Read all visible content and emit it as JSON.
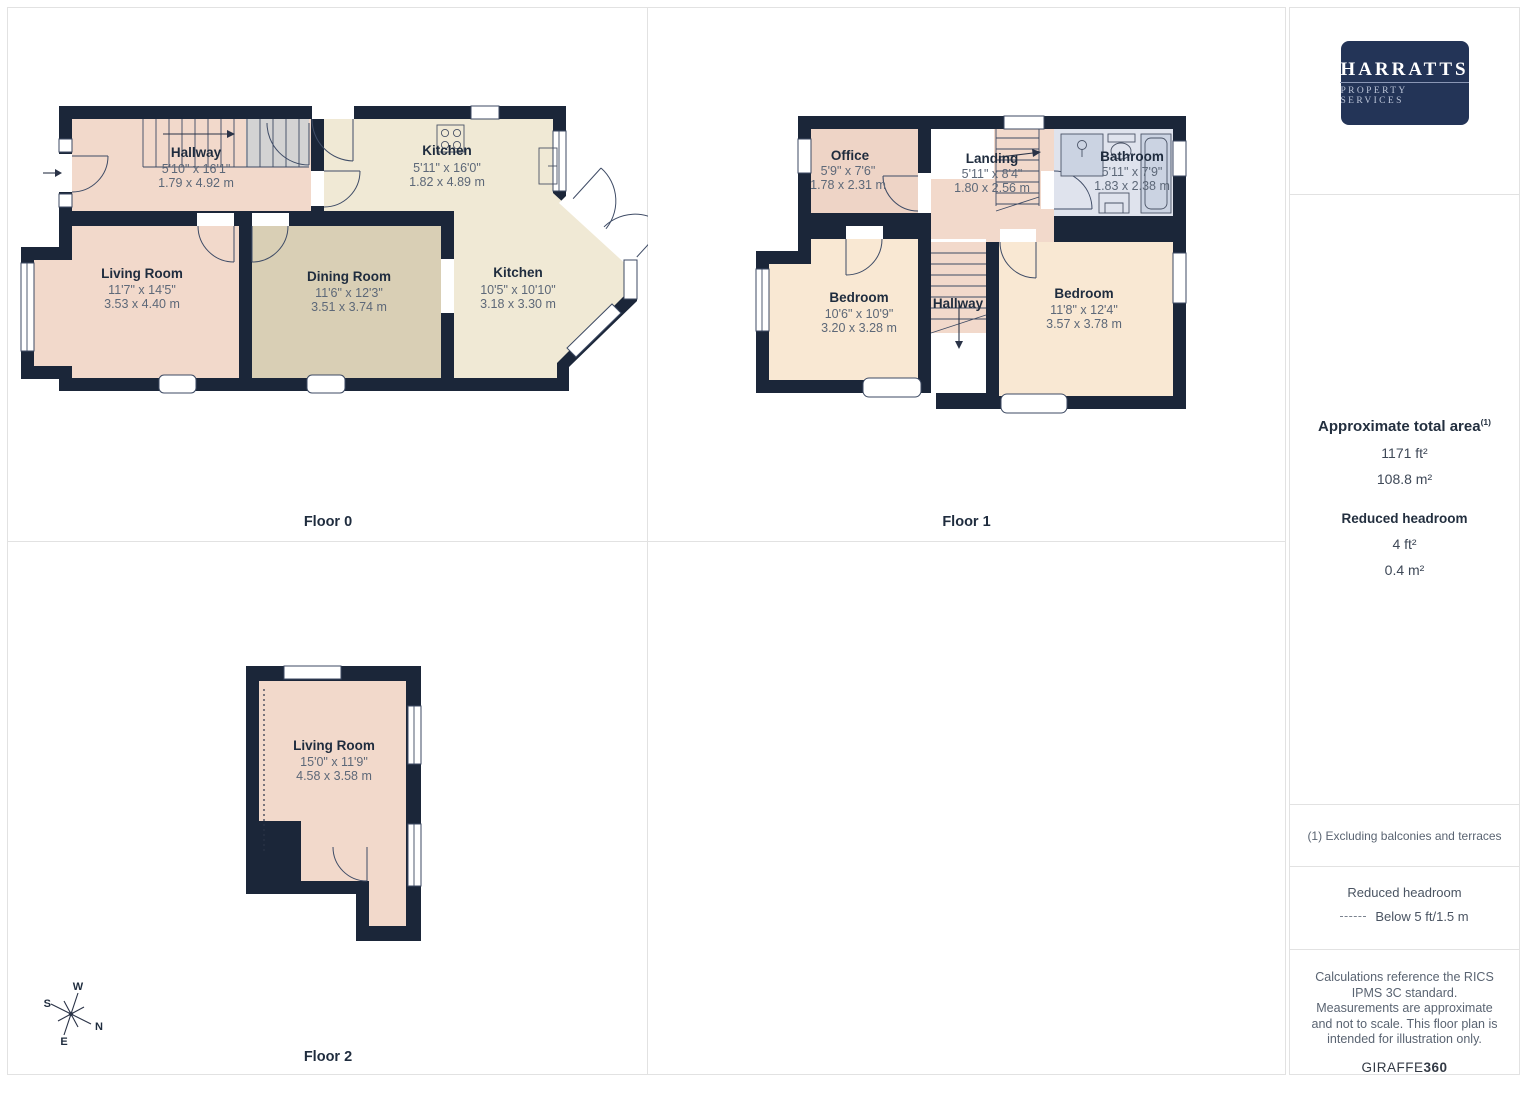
{
  "brand": {
    "logo_line1": "HARRATTS",
    "logo_line2": "PROPERTY SERVICES"
  },
  "sidebar": {
    "total_area": {
      "title": "Approximate total area",
      "superscript": "(1)",
      "value_ft": "1171 ft²",
      "value_m": "108.8 m²"
    },
    "reduced_headroom": {
      "title": "Reduced headroom",
      "value_ft": "4 ft²",
      "value_m": "0.4 m²"
    },
    "footnote": "(1) Excluding balconies and terraces",
    "legend": {
      "title": "Reduced headroom",
      "dash_label": "Below 5 ft/1.5 m"
    },
    "disclaimer": "Calculations reference the RICS IPMS 3C standard. Measurements are approximate and not to scale. This floor plan is intended for illustration only.",
    "watermark_regular": "GIRAFFE",
    "watermark_bold": "360"
  },
  "floors": [
    {
      "label": "Floor 0",
      "rooms": [
        {
          "name": "Hallway",
          "ft": "5'10\" x 16'1\"",
          "m": "1.79 x 4.92 m"
        },
        {
          "name": "Kitchen",
          "ft": "5'11\" x 16'0\"",
          "m": "1.82 x 4.89 m"
        },
        {
          "name": "Living Room",
          "ft": "11'7\" x 14'5\"",
          "m": "3.53 x 4.40 m"
        },
        {
          "name": "Dining Room",
          "ft": "11'6\" x 12'3\"",
          "m": "3.51 x 3.74 m"
        },
        {
          "name": "Kitchen",
          "ft": "10'5\" x 10'10\"",
          "m": "3.18 x 3.30 m"
        }
      ]
    },
    {
      "label": "Floor 1",
      "rooms": [
        {
          "name": "Office",
          "ft": "5'9\" x 7'6\"",
          "m": "1.78 x 2.31 m"
        },
        {
          "name": "Landing",
          "ft": "5'11\" x 8'4\"",
          "m": "1.80 x 2.56 m"
        },
        {
          "name": "Bathroom",
          "ft": "5'11\" x 7'9\"",
          "m": "1.83 x 2.38 m"
        },
        {
          "name": "Bedroom",
          "ft": "10'6\" x 10'9\"",
          "m": "3.20 x 3.28 m"
        },
        {
          "name": "Hallway",
          "ft": "",
          "m": ""
        },
        {
          "name": "Bedroom",
          "ft": "11'8\" x 12'4\"",
          "m": "3.57 x 3.78 m"
        }
      ]
    },
    {
      "label": "Floor 2",
      "rooms": [
        {
          "name": "Living Room",
          "ft": "15'0\" x 11'9\"",
          "m": "4.58 x 3.58 m"
        }
      ]
    }
  ],
  "compass": {
    "n": "N",
    "s": "S",
    "e": "E",
    "w": "W"
  },
  "colors": {
    "wall": "#1b2639",
    "room_pink": "#f2d9cb",
    "room_office": "#eed4c6",
    "room_tan": "#d9cfb5",
    "room_cream": "#f0e9d5",
    "room_bedroom": "#f9e8d3",
    "room_bathroom": "#dfe3ed",
    "stair_gray": "#d3d3d3",
    "logo_navy": "#233457",
    "grid_line": "#e2e2e2"
  }
}
